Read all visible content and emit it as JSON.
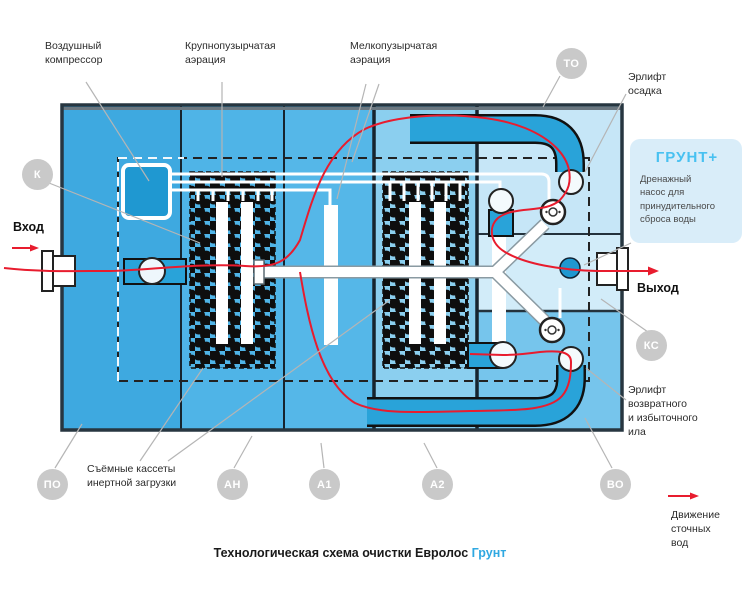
{
  "title": {
    "main": "Технологическая схема очистки Евролос",
    "brand": "Грунт"
  },
  "labels": {
    "compressor": "Воздушный\nкомпрессор",
    "coarse_aeration": "Крупнопузырчатая\nаэрация",
    "fine_aeration": "Мелкопузырчатая\nаэрация",
    "airlift_sludge": "Эрлифт\nосадка",
    "airlift_return": "Эрлифт\nвозвратного\nи избыточного\nила",
    "cassettes": "Съёмные кассеты\nинертной загрузки",
    "inlet": "Вход",
    "outlet": "Выход",
    "legend": "Движение\nсточных\nвод"
  },
  "info_box": {
    "title": "ГРУНТ+",
    "body": "Дренажный\nнасос для\nпринудительного\nсброса воды"
  },
  "badges": {
    "k": "К",
    "to": "ТО",
    "po": "ПО",
    "an": "АН",
    "a1": "А1",
    "a2": "А2",
    "vo": "ВО",
    "ks": "КС"
  },
  "colors": {
    "flow_red": "#e81c2e",
    "pipe_blue": "#29a3d9",
    "tank_po": "#3ea9e0",
    "tank_an": "#4fb4e7",
    "tank_a1": "#55b7e8",
    "tank_a2": "#8bcfef",
    "tank_vo_light": "#c6e6f7",
    "tank_vo_mid": "#d2ecf9",
    "tank_vo_deep": "#76c5ec",
    "badge_gray": "#c9c9c9",
    "brand_blue": "#2fa8e1",
    "info_box_bg": "#d9edf9",
    "info_box_title": "#48c1f1"
  }
}
